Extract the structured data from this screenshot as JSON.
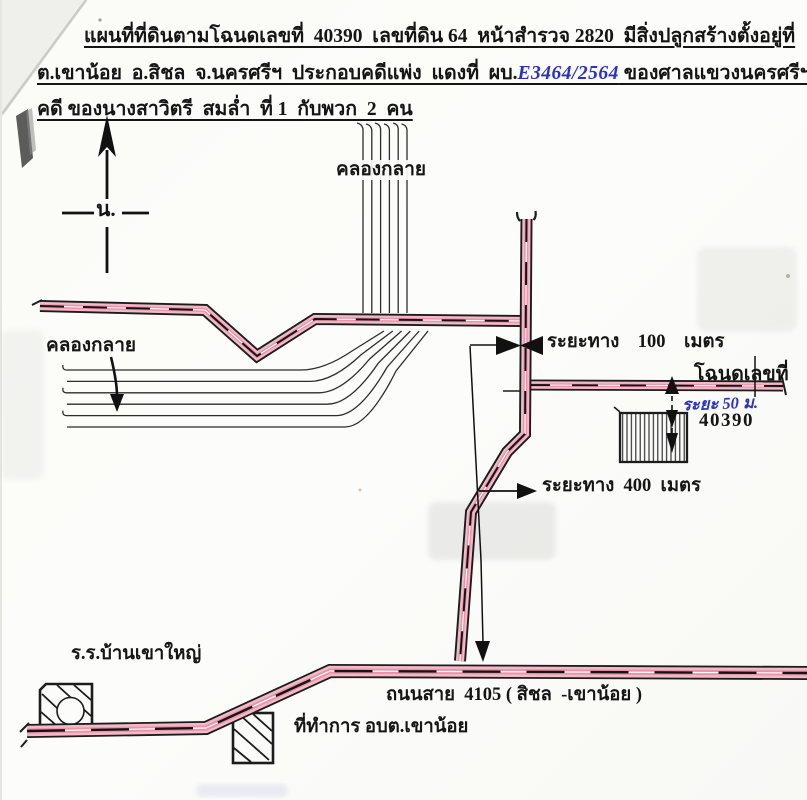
{
  "document": {
    "header": {
      "line1": "แผนที่ที่ดินตามโฉนดเลขที่  40390  เลขที่ดิน 64  หน้าสำรวจ 2820  มีสิ่งปลูกสร้างตั้งอยู่ที่",
      "line2_pre": "ต.เขาน้อย  อ.สิชล  จ.นครศรีฯ  ประกอบคดีแพ่ง  แดงที่  ผบ.",
      "line2_case_number": "E3464/2564",
      "line2_post": " ของศาลแขวงนครศรีฯ",
      "line3": "คดี ของนางสาวิตรี  สมล่ำ  ที่ 1  กับพวก  2  คน"
    },
    "compass": {
      "north_label": "น."
    },
    "labels": {
      "canal_upper": "คลองกลาย",
      "canal_lower": "คลองกลาย",
      "distance_100": "ระยะทาง    100    เมตร",
      "distance_400": "ระยะทาง  400  เมตร",
      "deed_title": "โฉนดเลขที่",
      "deed_number": "40390",
      "distance_50_handwritten": "ระยะ 50 ม.",
      "school": "ร.ร.บ้านเขาใหญ่",
      "road_4105": "ถนนสาย  4105 ( สิชล  -เขาน้อย )",
      "sao_office": "ที่ทำการ อบต.เขาน้อย"
    },
    "colors": {
      "road_highlight_pink": "#f3b9c8",
      "road_core_red": "#d96a82",
      "ink_black": "#1c1c1c",
      "handwriting_blue": "#2b32c2",
      "paper": "#fcfcfa"
    }
  }
}
